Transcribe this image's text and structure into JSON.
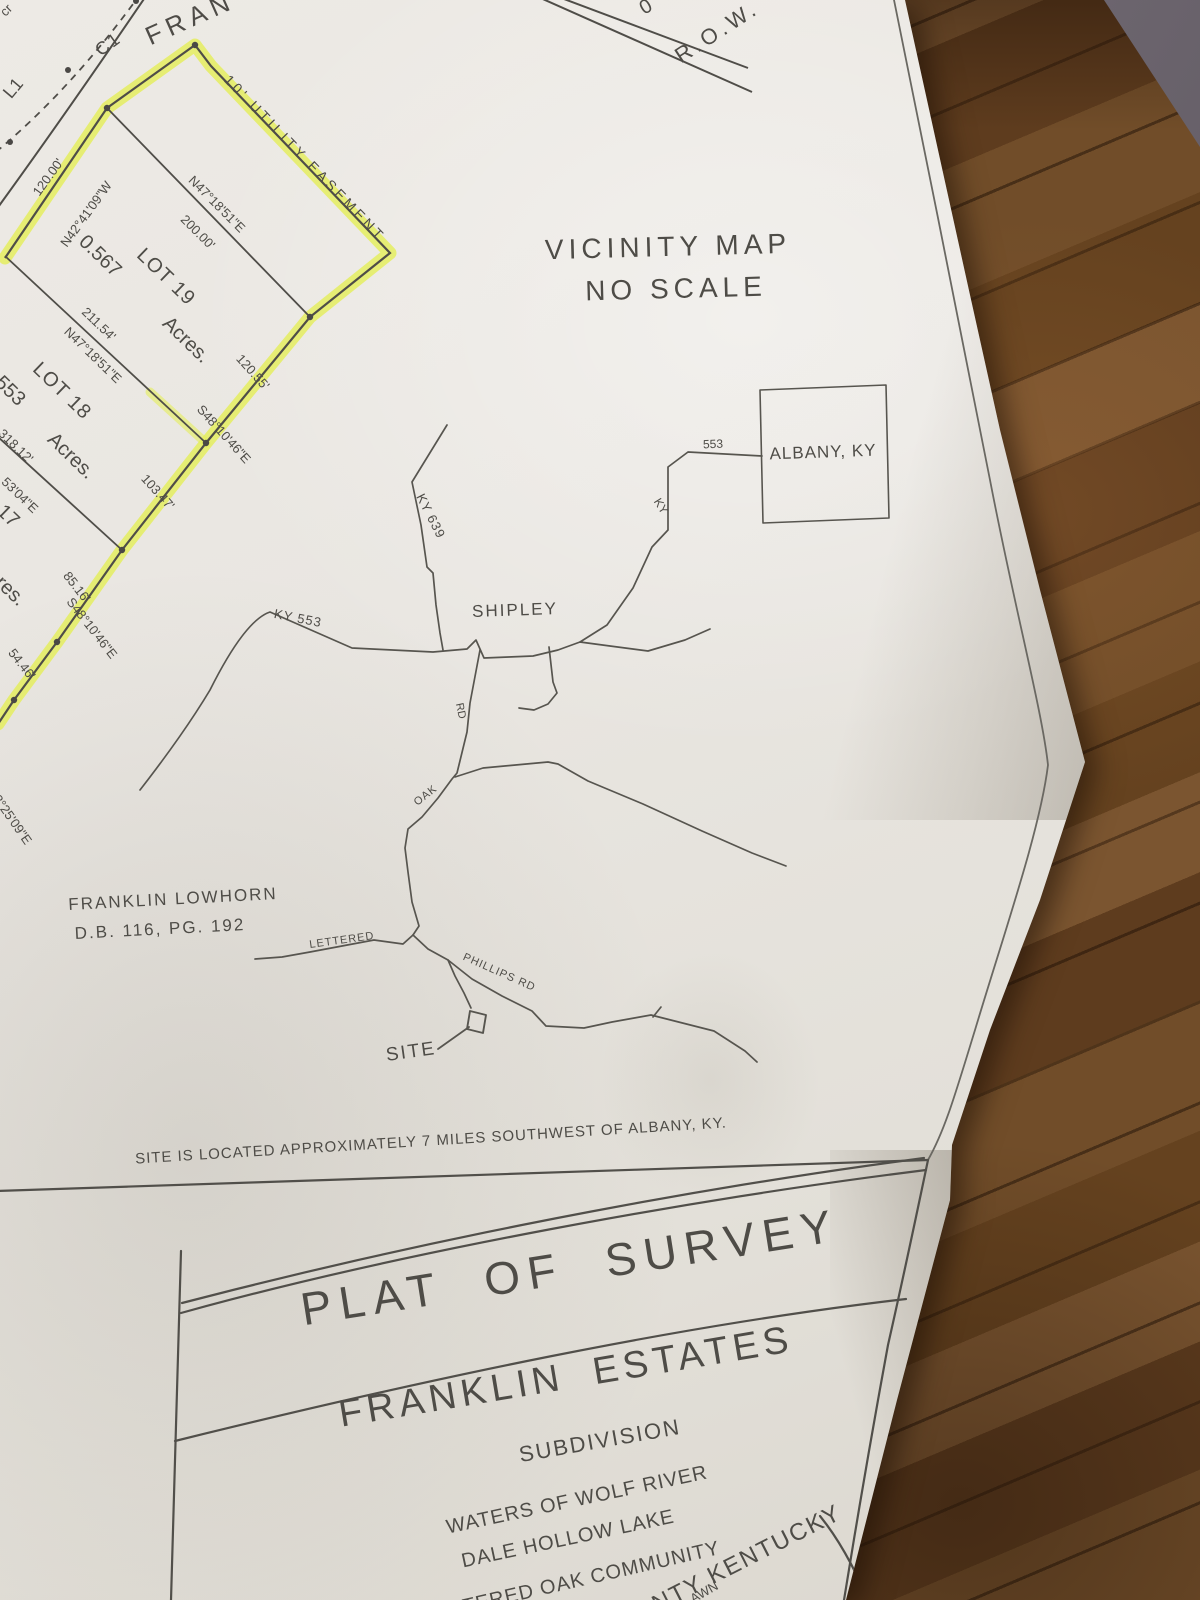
{
  "plat": {
    "corner_fragment": "cr",
    "road": {
      "c1": "C1",
      "name_partial": "FRAN",
      "l1": "L1",
      "row_prefix": "0",
      "row": "R.O.W."
    },
    "easement": "10' UTILITY EASEMENT",
    "lot19": {
      "label": "LOT 19",
      "area": "0.567",
      "acres": "Acres."
    },
    "lot18": {
      "label": "LOT 18",
      "area": "553",
      "acres": "Acres."
    },
    "lot17": {
      "label": "17",
      "acres": "Acres."
    },
    "dims": {
      "d120": "120.00'",
      "n4241": "N42°41'09\"W",
      "n4718a": "N47°18'51\"E",
      "d200": "200.00'",
      "d21154": "211.54'",
      "n4718b": "N47°18'51\"E",
      "d12055": "120.55'",
      "s4810a": "S48°10'46\"E",
      "d10347": "103.47'",
      "d31812": "318.12'",
      "s5304": "53'04\"E",
      "d8516": "85.16'",
      "s4810b": "S48°10'46\"E",
      "d5446": "54.46'",
      "s8325": "S83°25'09\"E"
    }
  },
  "vicinity": {
    "title": "VICINITY MAP",
    "subtitle": "NO SCALE",
    "roads": {
      "ky639": "KY 639",
      "ky553": "KY 553",
      "r553": "553",
      "ky": "KY",
      "oak": "OAK",
      "rd": "RD",
      "lettered": "LETTERED",
      "phillips": "PHILLIPS RD"
    },
    "places": {
      "shipley": "SHIPLEY",
      "albany": "ALBANY, KY",
      "site": "SITE"
    }
  },
  "adjoiner": {
    "name": "FRANKLIN LOWHORN",
    "deed": "D.B. 116, PG. 192"
  },
  "note": "SITE IS LOCATED APPROXIMATELY 7 MILES SOUTHWEST OF ALBANY, KY.",
  "title_block": {
    "title": "PLAT OF SURVEY",
    "subdivision_name": "FRANKLIN ESTATES",
    "subdivision_word": "SUBDIVISION",
    "waters_line1": "WATERS OF WOLF RIVER",
    "waters_line2": "DALE HOLLOW LAKE",
    "community": "LETTERED OAK COMMUNITY",
    "county_partial": "NTY KENTUCKY",
    "drawn_partial": "AWN"
  }
}
